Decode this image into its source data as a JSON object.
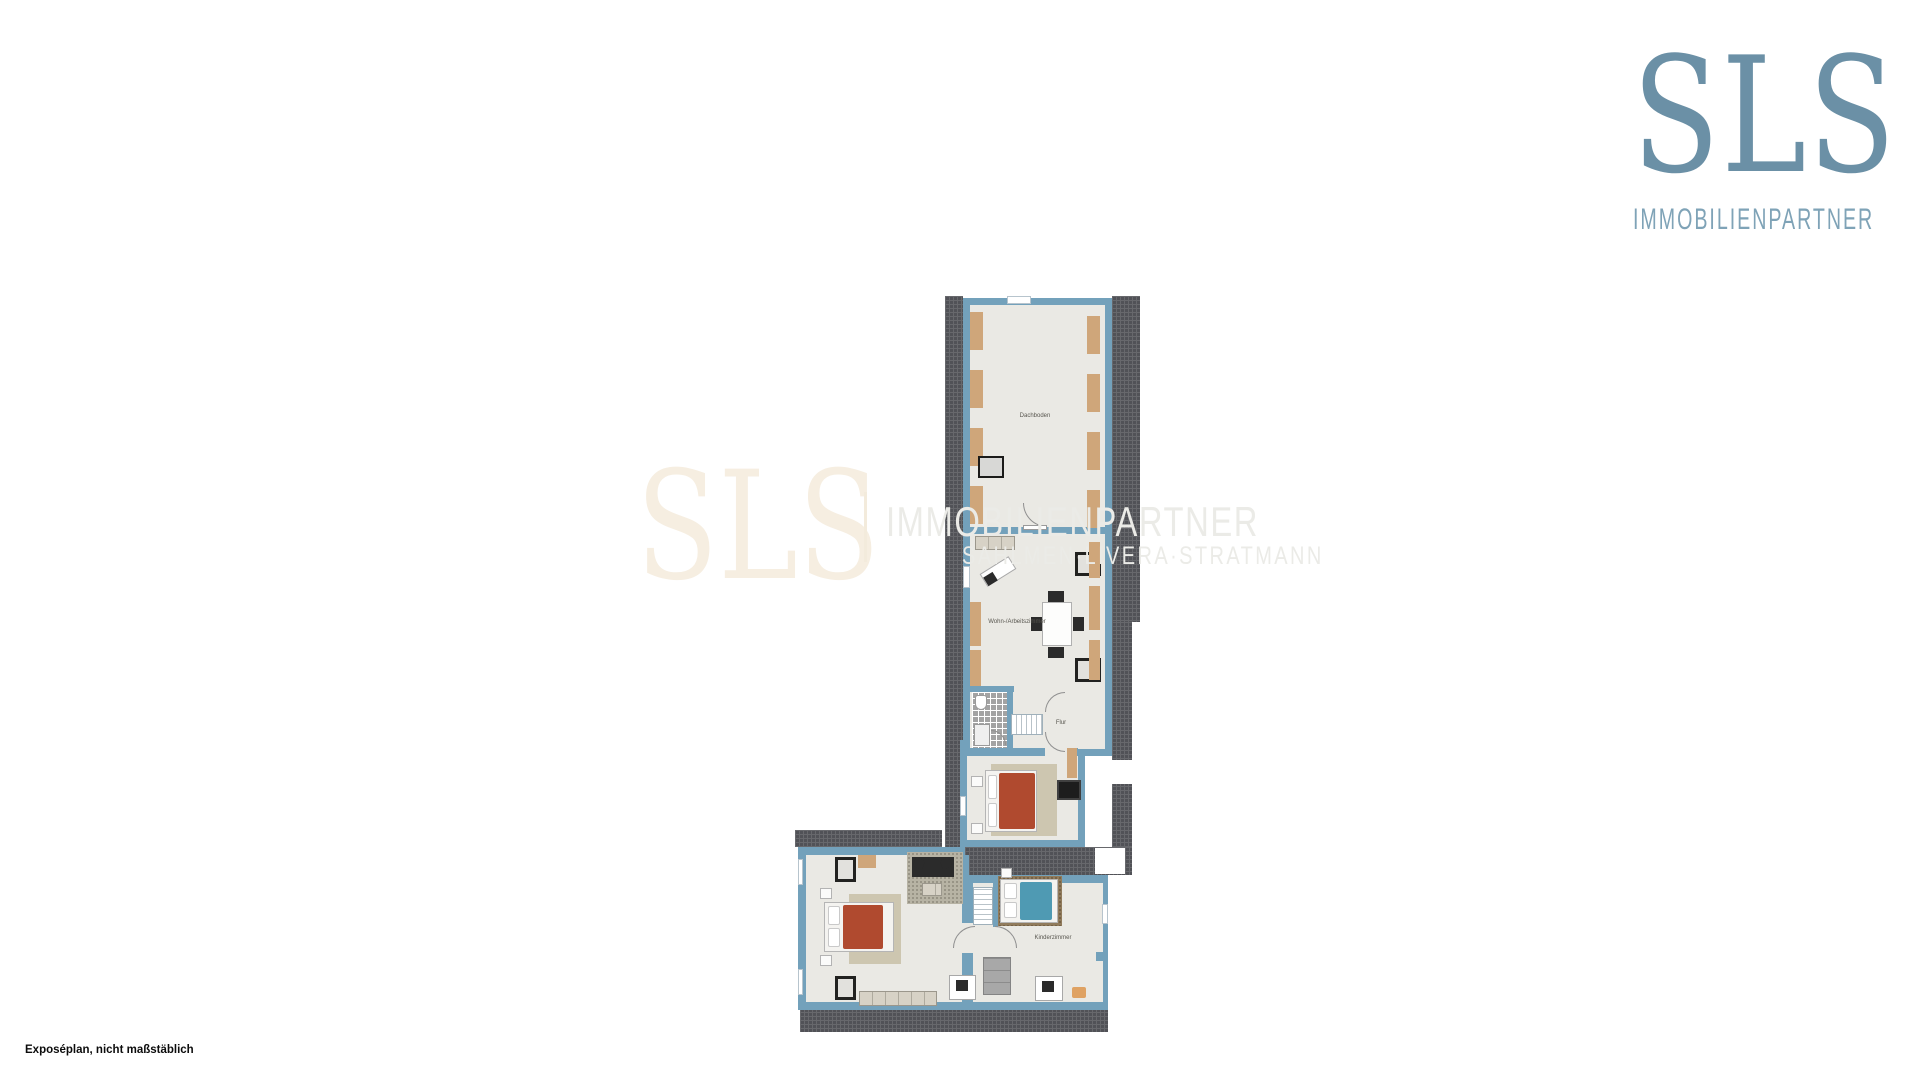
{
  "logo": {
    "brand": "SLS",
    "subtitle": "IMMOBILIENPARTNER"
  },
  "watermark": {
    "brand": "SLS",
    "line1": "IMMOBILIENPARTNER",
    "line2": "SAHLMEN·LIVERA·STRATMANN"
  },
  "floorplan": {
    "rooms": [
      {
        "id": "dachboden",
        "label": "Dachboden"
      },
      {
        "id": "wohn-arbeitszimmer",
        "label": "Wohn-/Arbeitszimmer"
      },
      {
        "id": "flur",
        "label": "Flur"
      },
      {
        "id": "kinderzimmer",
        "label": "Kinderzimmer"
      }
    ],
    "colors": {
      "wall": "#73a1bb",
      "roof_hatch": "#515257",
      "floor": "#eae9e4",
      "knee_wall": "#cfa67a",
      "bed_red": "#b04a2f",
      "bed_teal": "#4f9ab3",
      "logo_blue": "#6b90a6",
      "watermark_cream": "#f6eee1"
    }
  },
  "footer": {
    "note": "Exposéplan, nicht maßstäblich"
  }
}
